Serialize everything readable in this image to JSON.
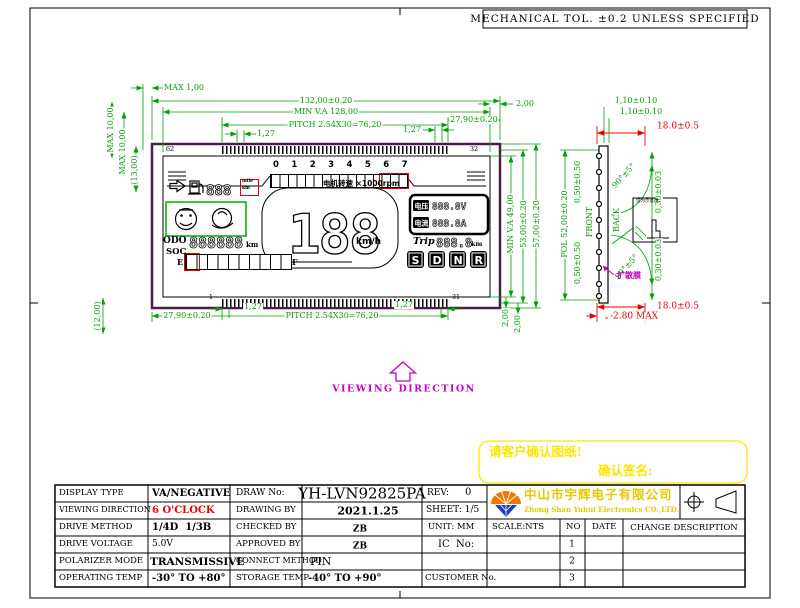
{
  "frame": {
    "tol_note": "MECHANICAL TOL. ±0.2 UNLESS SPECIFIED"
  },
  "dims": {
    "max_lip": "MAX 1,00",
    "overall_w": "132,00±0.20",
    "min_va_w": "MIN V.A 128,00",
    "pitch_top": "PITCH 2.54X30=76,20",
    "p127_tl": "1,27",
    "p127_tr": "1,27",
    "edge_top": "27,90±0.20",
    "gap_tr": "2,00",
    "max10_a": "MAX 10,00",
    "max10_b": "MAX 10,00",
    "ref_13": "(13,00)",
    "ref_12": "(12,00)",
    "edge_bottom": "27,90±0.20",
    "pitch_bottom": "PITCH 2.54X30=76,20",
    "p127_bl": "1,27",
    "p127_br": "1,27",
    "gap_br1": "2,00",
    "gap_br2": "2,00",
    "min_va_h": "MIN V.A 49,00",
    "pol_h": "53,00±0.20",
    "overall_h": "57,00±0.20",
    "pol_w": "POL 52,00±0.20",
    "off_top": "0,50±0.50",
    "off_bot": "0,50±0.50",
    "front": "FRONT",
    "back": "BACK",
    "layer_a": "1,10±0.10",
    "layer_b": "1,10±0.10",
    "pin_t": "18.0±0.5",
    "pin_b": "18.0±0.5",
    "thickness": "-2.80 MAX",
    "ang_t": "90°±5°",
    "ang_b": "90°±5°",
    "bend_t": "0,30±0.03",
    "bend_b": "0,30±0.03",
    "diffuser": "扩散膜",
    "detail_note": "仅为示意用"
  },
  "pins": {
    "top_left": "62",
    "top_right": "32",
    "bottom_left": "1",
    "bottom_right": "31"
  },
  "lcd": {
    "digit_row": "0 1 2 3 4 5 6 7",
    "tach": "电机转速 ×1000rpm",
    "fuel_value": "888",
    "fuel_unit_a": "mile",
    "fuel_unit_b": "km",
    "odo_label": "ODO",
    "odo_value": "888888",
    "odo_unit": "km",
    "soc_label": "SOC",
    "soc_e": "E",
    "soc_f": "F",
    "speed_value": "188",
    "speed_unit": "km/h",
    "volt_label": "电压",
    "volt_value": "888.8V",
    "curr_label": "电流",
    "curr_value": "888.8A",
    "trip_label": "Trip",
    "trip_value": "888.8",
    "trip_unit": "km",
    "gears": [
      "S",
      "D",
      "N",
      "R"
    ]
  },
  "viewing_direction": "VIEWING DIRECTION",
  "note": {
    "line1": "请客户确认图纸!",
    "line2": "确认签名:"
  },
  "company": {
    "name_cn": "中山市宇辉电子有限公司",
    "name_en": "Zhong Shan Yuhui Electronics CO.,LTD."
  },
  "title_block": {
    "display_type_label": "DISPLAY TYPE",
    "display_type": "VA/NEGATIVE",
    "draw_no_label": "DRAW No:",
    "draw_no": "YH-LVN92825PA",
    "rev_label": "REV:",
    "rev": "0",
    "viewing_label": "VIEWING DIRECTION",
    "viewing": "6 O'CLOCK",
    "drawing_by_label": "DRAWING BY",
    "drawing_by": "2021.1.25",
    "sheet": "SHEET: 1/5",
    "drive_method_label": "DRIVE METHOD",
    "drive_method": "1/4D  1/3B",
    "checked_by_label": "CHECKED BY",
    "checked_by": "ZB",
    "unit": "UNIT: MM",
    "scale": "SCALE:NTS",
    "no_col": "NO",
    "date_col": "DATE",
    "change_col": "CHANGE DESCRIPTION",
    "drive_voltage_label": "DRIVE VOLTAGE",
    "drive_voltage": "5.0V",
    "approved_by_label": "APPROVED BY",
    "approved_by": "ZB",
    "ic_label": "IC  No:",
    "polarizer_label": "POLARIZER MODE",
    "polarizer": "TRANSMISSIVE",
    "connect_label": "CONNECT METHOD",
    "connect": "PIN",
    "operating_label": "OPERATING TEMP",
    "operating": "-30° TO +80°",
    "storage_label": "STORAGE TEMP",
    "storage": "-40° TO +90°",
    "customer_label": "CUSTOMER No.",
    "rows_no": [
      "1",
      "2",
      "3"
    ]
  },
  "colors": {
    "dim_green": "#00a000",
    "alert_red": "#ee0000",
    "magenta": "#c400c4",
    "note_yellow": "#ffe400",
    "company_yellow": "#e8c800",
    "glass_purple": "#4a1e4a"
  }
}
